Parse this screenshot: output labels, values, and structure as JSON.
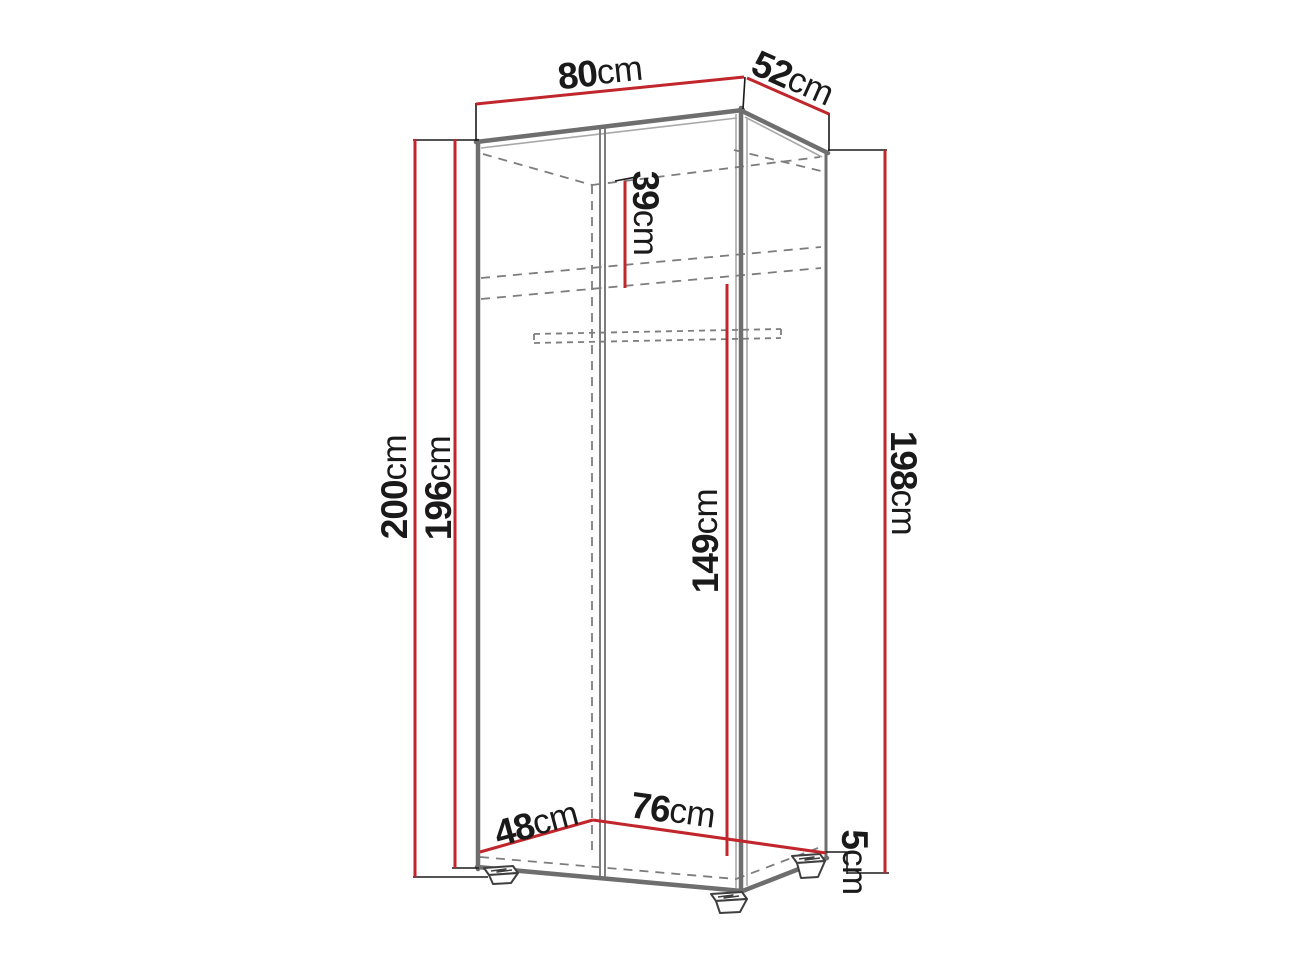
{
  "diagram": {
    "title": "Wardrobe dimension diagram",
    "type": "furniture-dimension-diagram",
    "unit": "cm",
    "colors": {
      "dimension_line": "#c0262b",
      "outline": "#6e6e6e",
      "dashed": "#7d7d7d",
      "extension_line": "#1a1a1a",
      "label_text": "#1a1a1a",
      "background": "#ffffff"
    },
    "dimensions": {
      "top_width": {
        "value": "80",
        "unit": "cm"
      },
      "top_depth": {
        "value": "52",
        "unit": "cm"
      },
      "height_total": {
        "value": "200",
        "unit": "cm"
      },
      "height_body": {
        "value": "196",
        "unit": "cm"
      },
      "height_right": {
        "value": "198",
        "unit": "cm"
      },
      "top_section": {
        "value": "39",
        "unit": "cm"
      },
      "hanging_space": {
        "value": "149",
        "unit": "cm"
      },
      "inner_depth": {
        "value": "48",
        "unit": "cm"
      },
      "inner_width": {
        "value": "76",
        "unit": "cm"
      },
      "feet_height": {
        "value": "5",
        "unit": "cm"
      }
    }
  }
}
